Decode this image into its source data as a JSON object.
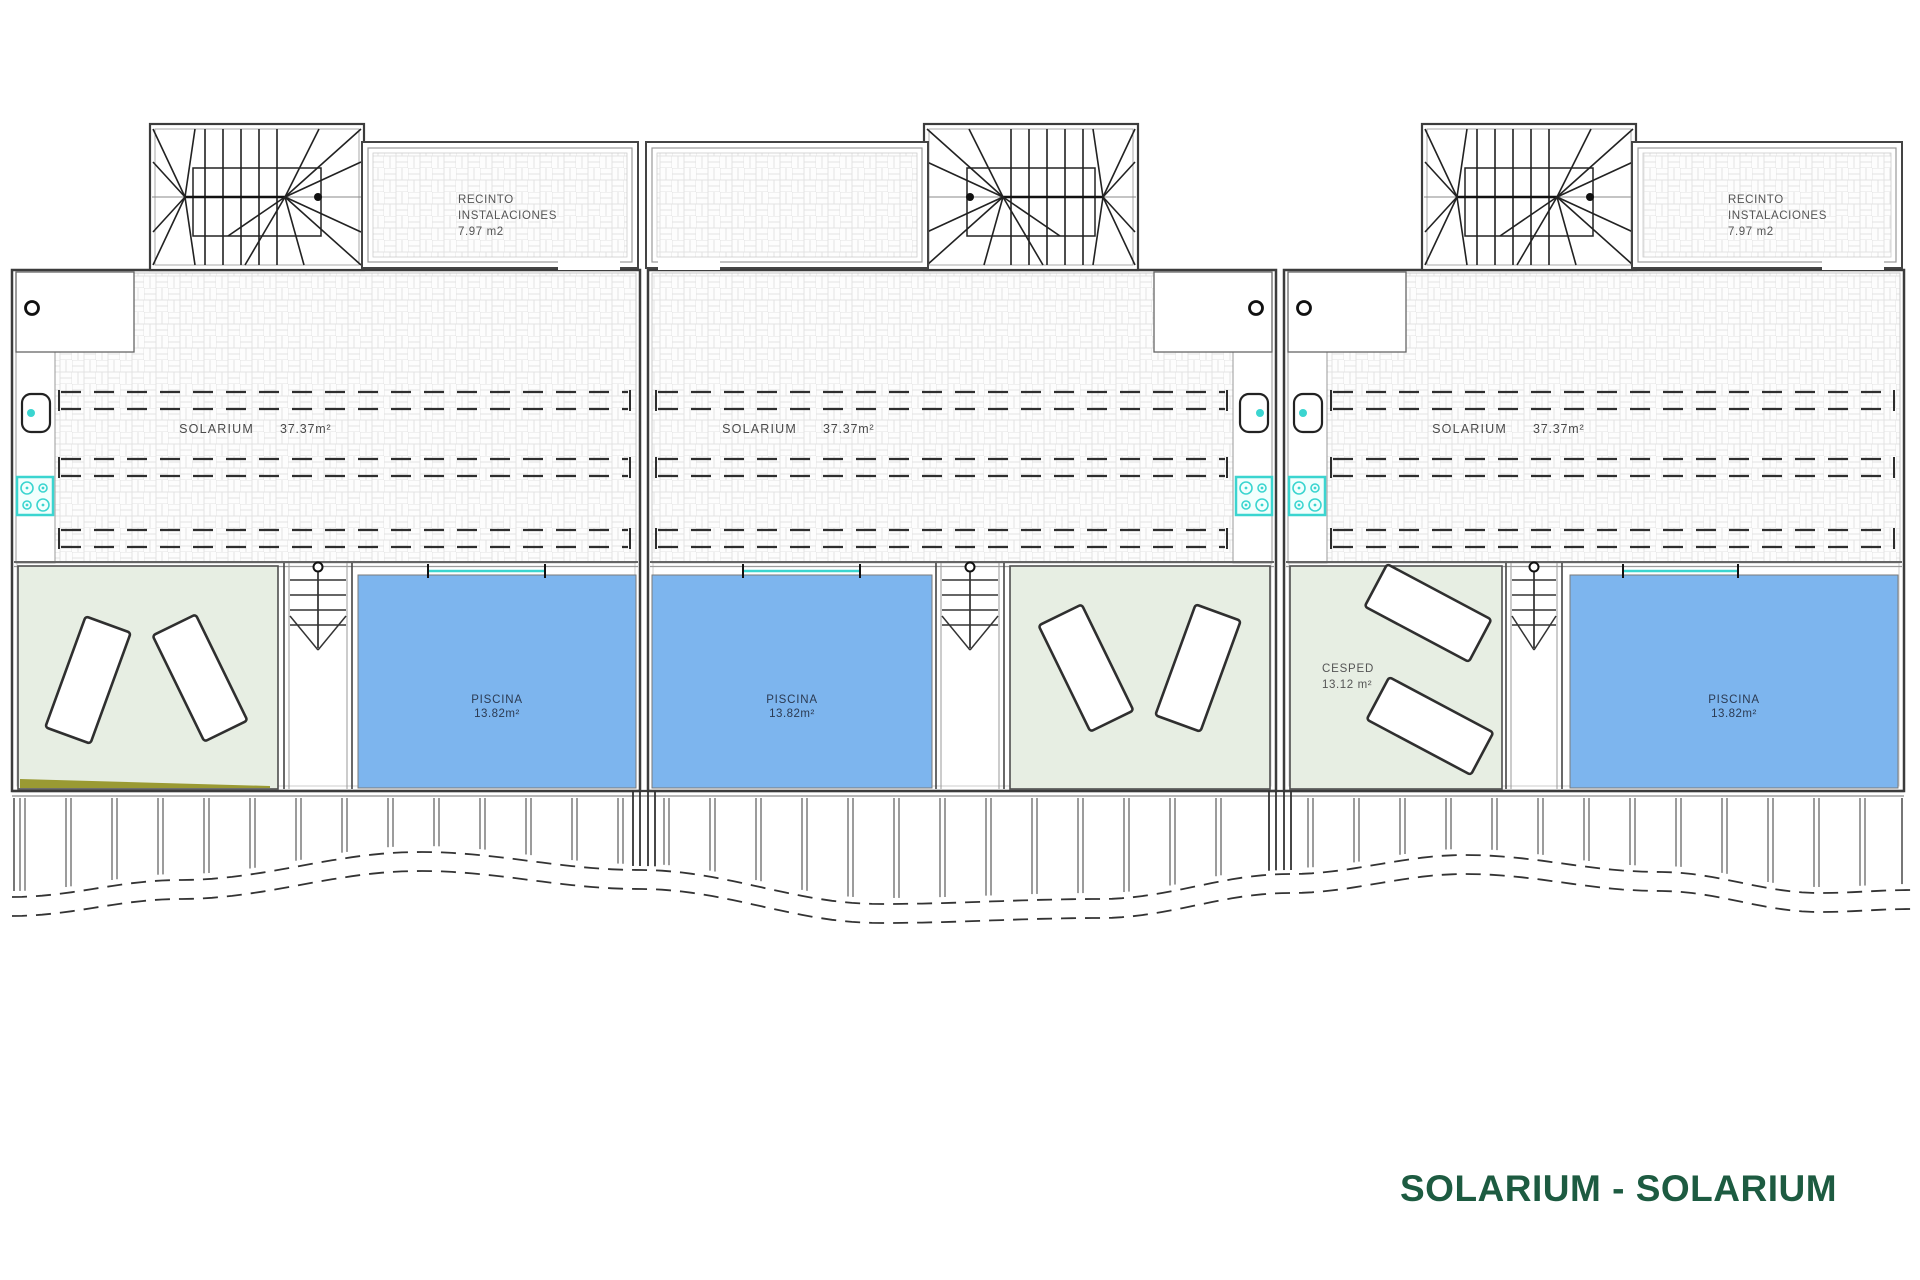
{
  "title": {
    "text": "SOLARIUM - SOLARIUM",
    "color": "#1d5b41"
  },
  "colors": {
    "pool_fill": "#7db5ee",
    "pool_text": "#2b3a52",
    "lawn_fill": "#e7eee3",
    "lawn_edge": "#4f4f4f",
    "tile_line": "#e2e2e2",
    "wall_dark": "#3c3c3c",
    "wall_mid": "#666666",
    "wall_light": "#9a9a9a",
    "stair_line": "#222222",
    "dash_line": "#2e2e2e",
    "cyan_accent": "#3bd5d0",
    "olive_strip": "#9a9a33",
    "label_text": "#4a4a4a"
  },
  "labels": {
    "solarium": "SOLARIUM",
    "solarium_area": "37.37m²",
    "piscina": "PISCINA",
    "piscina_area": "13.82m²",
    "cesped": "CESPED",
    "cesped_area": "13.12 m²",
    "recinto": [
      "RECINTO",
      "INSTALACIONES",
      "7.97 m2"
    ]
  },
  "plan": {
    "canvas": {
      "w": 1920,
      "h": 1280
    },
    "rows": {
      "strip_top": 124,
      "recinto_top": 142,
      "recinto_bottom": 268,
      "main_top": 270,
      "solarium_bottom": 563,
      "lawn_top": 566,
      "lawn_bottom": 789,
      "pool_top": 575,
      "pool_bottom": 788,
      "deck_top": 791,
      "label_y": 433,
      "dash_pairs": [
        [
          392,
          409
        ],
        [
          459,
          476
        ],
        [
          530,
          547
        ]
      ]
    },
    "units": [
      {
        "id": "unit-1",
        "box": [
          12,
          640
        ],
        "kitchen_side": "left",
        "stair_enclosure": [
          150,
          364
        ],
        "recinto": [
          362,
          638
        ],
        "recinto_label": true,
        "lawn": [
          18,
          278
        ],
        "shaft": [
          284,
          352
        ],
        "pool": [
          358,
          636
        ],
        "solarium_label_x": 267,
        "pool_accent": [
          428,
          545
        ],
        "olive": true,
        "cesped": false,
        "loungers": [
          {
            "cx": 88,
            "cy": 680,
            "rot": 20
          },
          {
            "cx": 200,
            "cy": 678,
            "rot": -26
          }
        ]
      },
      {
        "id": "unit-2",
        "box": [
          648,
          1276
        ],
        "kitchen_side": "right",
        "stair_enclosure": [
          924,
          1138
        ],
        "recinto": [
          646,
          928
        ],
        "recinto_label": false,
        "lawn": [
          1010,
          1270
        ],
        "shaft": [
          936,
          1004
        ],
        "pool": [
          652,
          932
        ],
        "solarium_label_x": 810,
        "pool_accent": [
          743,
          860
        ],
        "olive": false,
        "cesped": false,
        "loungers": [
          {
            "cx": 1086,
            "cy": 668,
            "rot": -26
          },
          {
            "cx": 1198,
            "cy": 668,
            "rot": 20
          }
        ]
      },
      {
        "id": "unit-3",
        "box": [
          1284,
          1904
        ],
        "kitchen_side": "left",
        "stair_enclosure": [
          1422,
          1636
        ],
        "recinto": [
          1632,
          1902
        ],
        "recinto_label": true,
        "lawn": [
          1290,
          1502
        ],
        "shaft": [
          1506,
          1562
        ],
        "pool": [
          1570,
          1898
        ],
        "solarium_label_x": 1520,
        "pool_accent": [
          1623,
          1738
        ],
        "olive": false,
        "cesped": true,
        "loungers": [
          {
            "cx": 1428,
            "cy": 613,
            "rot": -62
          },
          {
            "cx": 1430,
            "cy": 726,
            "rot": -62
          }
        ]
      }
    ],
    "deck": {
      "left": 12,
      "right": 1904,
      "slat_step": 46,
      "wave_gap": 19,
      "boundaries": [
        [
          633,
          640,
          648,
          655
        ],
        [
          1269,
          1276,
          1284,
          1291
        ]
      ],
      "wave": [
        [
          12,
          897
        ],
        [
          180,
          880
        ],
        [
          420,
          852
        ],
        [
          640,
          870
        ],
        [
          880,
          904
        ],
        [
          1100,
          899
        ],
        [
          1290,
          874
        ],
        [
          1465,
          855
        ],
        [
          1660,
          872
        ],
        [
          1820,
          893
        ],
        [
          1912,
          890
        ]
      ]
    }
  }
}
